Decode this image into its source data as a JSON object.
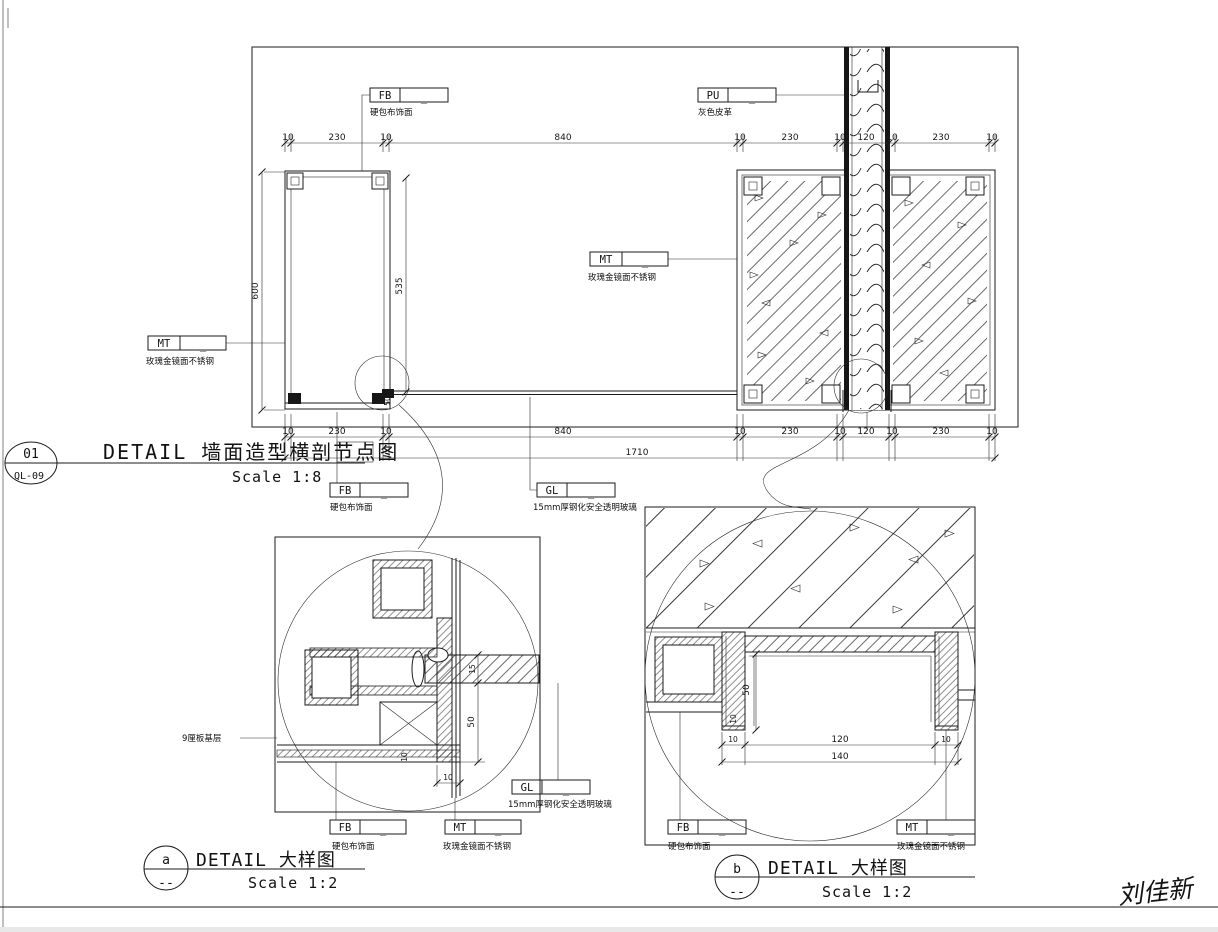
{
  "sheet": {
    "signature": "刘佳新"
  },
  "material_labels": {
    "fb": {
      "code": "FB",
      "value": "_",
      "desc": "硬包布饰面"
    },
    "pu": {
      "code": "PU",
      "value": "_",
      "desc": "灰色皮革"
    },
    "mt": {
      "code": "MT",
      "value": "_",
      "desc": "玫瑰金镜面不锈钢"
    },
    "gl": {
      "code": "GL",
      "value": "_",
      "desc": "15mm厚钢化安全透明玻璃"
    }
  },
  "notes": {
    "board": "9厘板基层"
  },
  "titles": {
    "main": {
      "num": "01",
      "ref": "QL-09",
      "name": "DETAIL  墙面造型横剖节点图",
      "scale": "Scale 1:8"
    },
    "a": {
      "num": "a",
      "ref": "--",
      "name": "DETAIL  大样图",
      "scale": "Scale 1:2"
    },
    "b": {
      "num": "b",
      "ref": "--",
      "name": "DETAIL  大样图",
      "scale": "Scale 1:2"
    }
  },
  "dims": {
    "main_top": [
      "10",
      "230",
      "10",
      "840",
      "10",
      "230",
      "10",
      "120",
      "10",
      "230",
      "10"
    ],
    "main_bottom": [
      "10",
      "230",
      "10",
      "840",
      "10",
      "230",
      "10",
      "120",
      "10",
      "230",
      "10"
    ],
    "main_total": "1710",
    "main_height": "600",
    "main_inner_height": "535",
    "main_glass_offset": "50",
    "a_glass": "15",
    "a_depth": "50",
    "a_board": "10",
    "a_gap": "10",
    "b_depth": "50",
    "b_jamb": "10",
    "b_left": "10",
    "b_mid": "120",
    "b_right": "10",
    "b_total": "140"
  }
}
